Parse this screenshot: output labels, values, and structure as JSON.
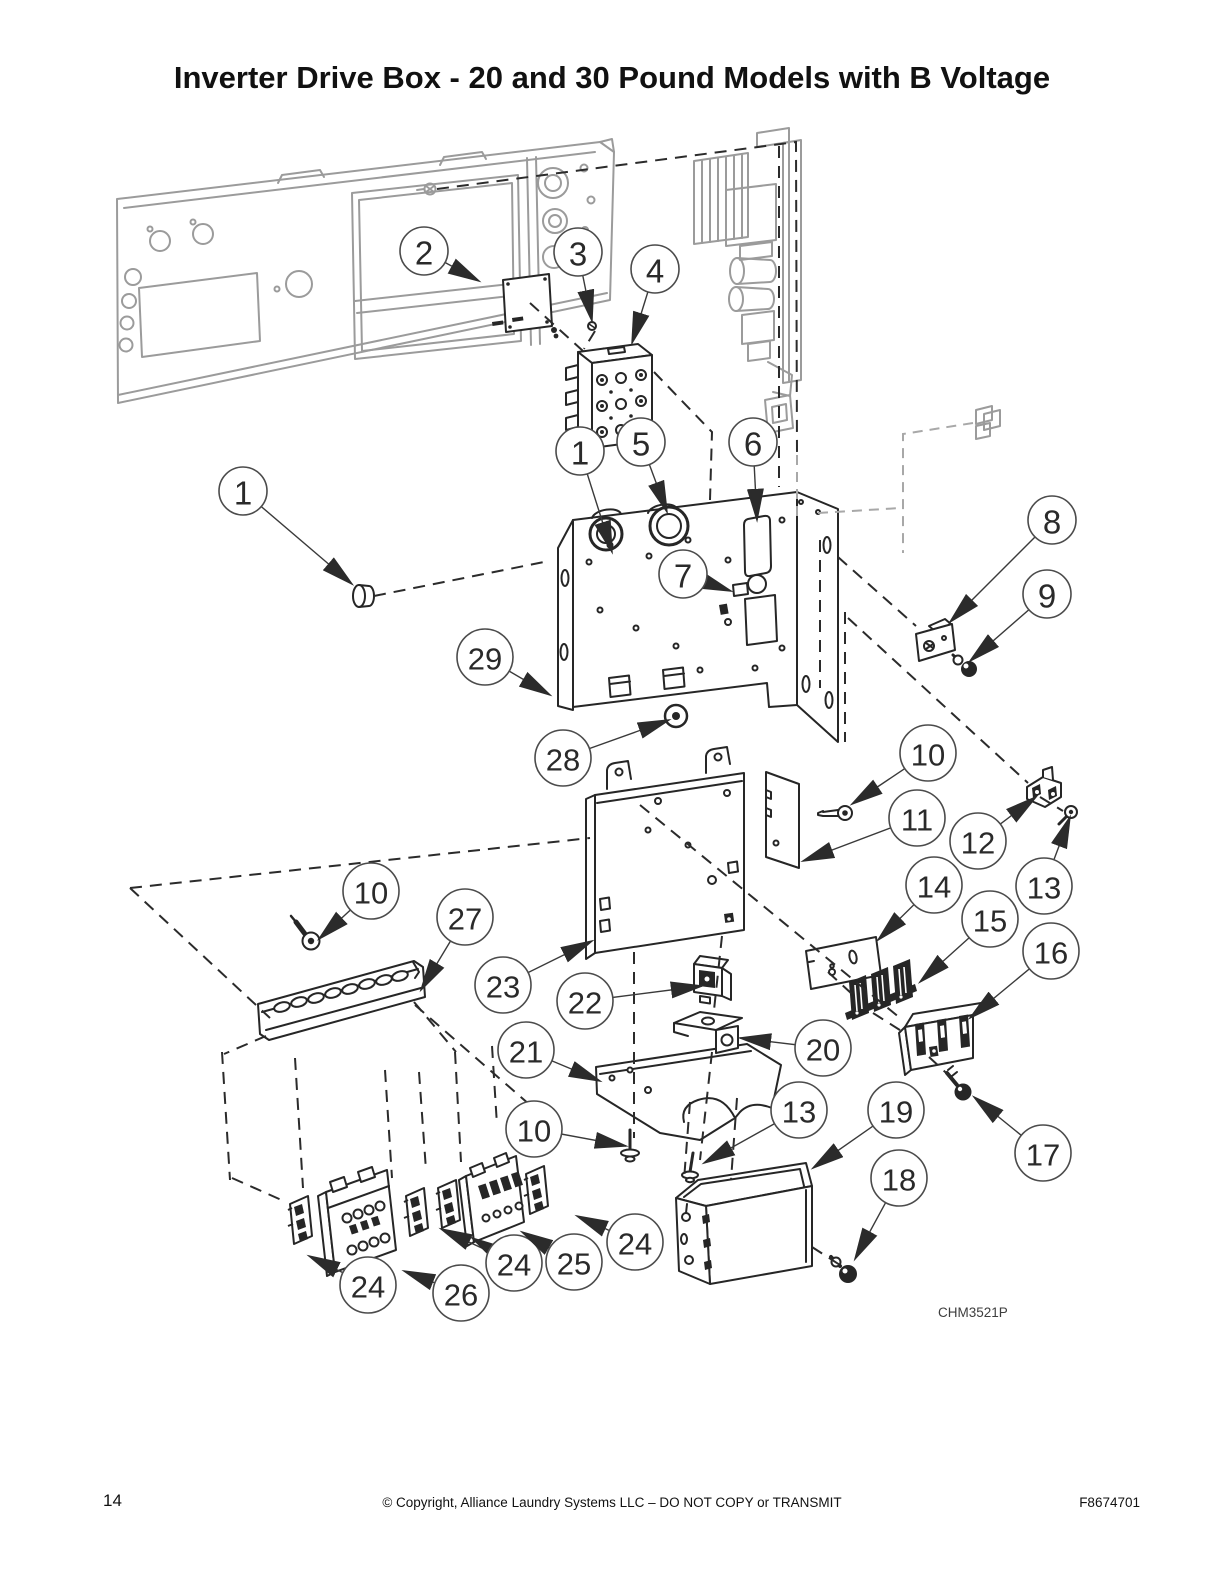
{
  "page": {
    "title": "Inverter Drive Box - 20 and 30 Pound Models with B Voltage",
    "page_number": "14",
    "copyright_line": "© Copyright, Alliance Laundry Systems LLC – DO NOT COPY or TRANSMIT",
    "document_number": "F8674701",
    "figure_code": "CHM3521P"
  },
  "colors": {
    "line": "#2b2b2b",
    "ghost": "#9b9b9b",
    "balloon_stroke": "#4b4b4b"
  },
  "callouts": [
    {
      "label": "2",
      "cx": 424,
      "cy": 251,
      "arrows": [
        [
          479,
          281
        ]
      ]
    },
    {
      "label": "3",
      "cx": 578,
      "cy": 252,
      "arrows": [
        [
          592,
          321
        ]
      ]
    },
    {
      "label": "4",
      "cx": 655,
      "cy": 269,
      "arrows": [
        [
          632,
          343
        ]
      ]
    },
    {
      "label": "1",
      "cx": 243,
      "cy": 491,
      "arrows": [
        [
          352,
          584
        ]
      ]
    },
    {
      "label": "1",
      "cx": 580,
      "cy": 451,
      "arrows": [
        [
          612,
          552
        ]
      ]
    },
    {
      "label": "5",
      "cx": 641,
      "cy": 442,
      "arrows": [
        [
          667,
          512
        ]
      ]
    },
    {
      "label": "6",
      "cx": 753,
      "cy": 442,
      "arrows": [
        [
          757,
          520
        ]
      ]
    },
    {
      "label": "7",
      "cx": 683,
      "cy": 574,
      "arrows": [
        [
          731,
          591
        ]
      ]
    },
    {
      "label": "8",
      "cx": 1052,
      "cy": 520,
      "arrows": [
        [
          950,
          622
        ]
      ]
    },
    {
      "label": "9",
      "cx": 1047,
      "cy": 594,
      "arrows": [
        [
          970,
          661
        ]
      ]
    },
    {
      "label": "29",
      "cx": 485,
      "cy": 657,
      "arrows": [
        [
          550,
          695
        ]
      ]
    },
    {
      "label": "28",
      "cx": 563,
      "cy": 758,
      "arrows": [
        [
          669,
          720
        ]
      ]
    },
    {
      "label": "10",
      "cx": 928,
      "cy": 753,
      "arrows": [
        [
          852,
          804
        ]
      ]
    },
    {
      "label": "11",
      "cx": 917,
      "cy": 818,
      "arrows": [
        [
          803,
          861
        ]
      ]
    },
    {
      "label": "12",
      "cx": 978,
      "cy": 841,
      "arrows": [
        [
          1036,
          797
        ]
      ]
    },
    {
      "label": "13",
      "cx": 1044,
      "cy": 886,
      "arrows": [
        [
          1070,
          817
        ]
      ]
    },
    {
      "label": "14",
      "cx": 934,
      "cy": 885,
      "arrows": [
        [
          878,
          940
        ]
      ]
    },
    {
      "label": "15",
      "cx": 990,
      "cy": 919,
      "arrows": [
        [
          920,
          982
        ]
      ]
    },
    {
      "label": "16",
      "cx": 1051,
      "cy": 951,
      "arrows": [
        [
          970,
          1018
        ]
      ]
    },
    {
      "label": "10",
      "cx": 371,
      "cy": 891,
      "arrows": [
        [
          319,
          939
        ]
      ]
    },
    {
      "label": "27",
      "cx": 465,
      "cy": 917,
      "arrows": [
        [
          421,
          990
        ]
      ]
    },
    {
      "label": "23",
      "cx": 503,
      "cy": 985,
      "arrows": [
        [
          592,
          941
        ]
      ]
    },
    {
      "label": "22",
      "cx": 585,
      "cy": 1001,
      "arrows": [
        [
          702,
          986
        ]
      ]
    },
    {
      "label": "21",
      "cx": 526,
      "cy": 1050,
      "arrows": [
        [
          600,
          1081
        ]
      ]
    },
    {
      "label": "20",
      "cx": 823,
      "cy": 1048,
      "arrows": [
        [
          740,
          1038
        ]
      ]
    },
    {
      "label": "10",
      "cx": 534,
      "cy": 1129,
      "arrows": [
        [
          626,
          1146
        ]
      ]
    },
    {
      "label": "13",
      "cx": 799,
      "cy": 1110,
      "arrows": [
        [
          704,
          1163
        ]
      ]
    },
    {
      "label": "19",
      "cx": 896,
      "cy": 1110,
      "arrows": [
        [
          813,
          1168
        ]
      ]
    },
    {
      "label": "18",
      "cx": 899,
      "cy": 1178,
      "arrows": [
        [
          855,
          1259
        ]
      ]
    },
    {
      "label": "17",
      "cx": 1043,
      "cy": 1153,
      "arrows": [
        [
          974,
          1097
        ]
      ]
    },
    {
      "label": "24",
      "cx": 368,
      "cy": 1285,
      "arrows": [
        [
          309,
          1256
        ]
      ]
    },
    {
      "label": "26",
      "cx": 461,
      "cy": 1293,
      "arrows": [
        [
          404,
          1271
        ]
      ]
    },
    {
      "label": "24",
      "cx": 514,
      "cy": 1263,
      "arrows": [
        [
          441,
          1229
        ],
        [
          472,
          1238
        ]
      ]
    },
    {
      "label": "25",
      "cx": 574,
      "cy": 1262,
      "arrows": [
        [
          522,
          1232
        ]
      ]
    },
    {
      "label": "24",
      "cx": 635,
      "cy": 1242,
      "arrows": [
        [
          577,
          1216
        ]
      ]
    }
  ]
}
